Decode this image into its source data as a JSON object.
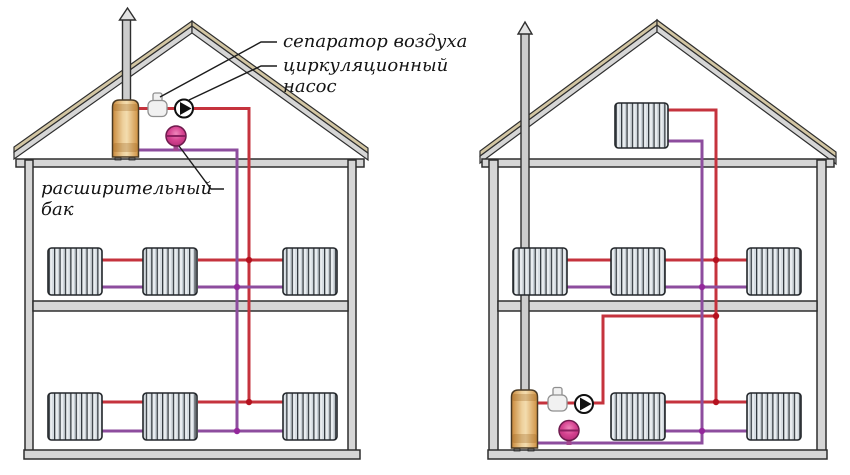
{
  "labels": {
    "air_separator": "сепаратор воздуха",
    "circulation_pump": "циркуляционный насос",
    "expansion_tank": "расширительный бак"
  },
  "colors": {
    "background": "#ffffff",
    "outline": "#2e2e2e",
    "structure": "#d6d6d6",
    "roof": "#d3c6a3",
    "chimney": "#cdcdcd",
    "supply": "#c5333d",
    "supply-node": "#b5121f",
    "return": "#8d4d9e",
    "return-node": "#93279b",
    "boiler": "#e8b061",
    "tank": "#d64491",
    "radiator": "#e9edf0"
  },
  "left_house": {
    "radiator_count": 6,
    "components": [
      "boiler",
      "chimney",
      "air-separator",
      "circulation-pump",
      "expansion-tank"
    ]
  },
  "right_house": {
    "radiator_count": 6,
    "components": [
      "boiler",
      "chimney",
      "air-separator",
      "circulation-pump",
      "expansion-tank"
    ]
  },
  "pipes": {
    "supply_color_meaning": "supply",
    "return_color_meaning": "return"
  }
}
